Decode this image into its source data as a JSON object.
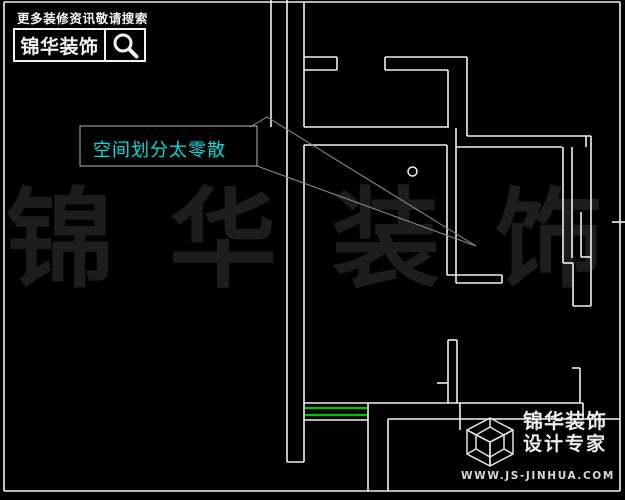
{
  "colors": {
    "background": "#000000",
    "wall": "#f0f0f0",
    "window_green": "#00c400",
    "leader": "#8d8d8d",
    "label_border": "#aeb4b4",
    "label_text": "#00dcdc",
    "watermark": "#1d1d1d",
    "logo_white": "#f2f2f2",
    "logo_gray": "#d8d8d8"
  },
  "header": {
    "tagline": "更多装修资讯敬请搜索",
    "brand": "锦华装饰",
    "search_icon": "magnifier-icon"
  },
  "annotation": {
    "text": "空间划分太零散"
  },
  "watermark": {
    "text": "锦华装饰"
  },
  "footer": {
    "cube_icon": "wireframe-cube-icon",
    "brand_line1": "锦华装饰",
    "brand_line2": "设计专家",
    "website": "WWW.JS-JINHUA.COM"
  },
  "floorplan": {
    "canvas": {
      "width": 625,
      "height": 500
    },
    "wall_segments": [
      [
        4,
        2,
        620,
        2
      ],
      [
        620,
        2,
        620,
        491
      ],
      [
        4,
        491,
        620,
        491
      ],
      [
        4,
        2,
        4,
        491
      ],
      [
        271,
        0,
        271,
        127
      ],
      [
        287,
        0,
        287,
        462
      ],
      [
        304,
        3,
        304,
        127
      ],
      [
        304,
        145,
        304,
        462
      ],
      [
        287,
        462,
        304,
        462
      ],
      [
        304,
        57,
        337,
        57
      ],
      [
        337,
        57,
        337,
        70
      ],
      [
        304,
        70,
        337,
        70
      ],
      [
        385,
        57,
        467,
        57
      ],
      [
        385,
        57,
        385,
        70
      ],
      [
        385,
        70,
        448,
        70
      ],
      [
        448,
        70,
        448,
        127
      ],
      [
        467,
        57,
        467,
        136
      ],
      [
        304,
        127,
        449,
        127
      ],
      [
        304,
        145,
        447,
        145
      ],
      [
        467,
        136,
        591,
        136
      ],
      [
        456,
        147,
        562,
        147
      ],
      [
        586,
        136,
        586,
        147
      ],
      [
        447,
        145,
        447,
        275
      ],
      [
        456,
        128,
        456,
        283
      ],
      [
        447,
        275,
        502,
        275
      ],
      [
        456,
        283,
        502,
        283
      ],
      [
        502,
        275,
        502,
        283
      ],
      [
        563,
        147,
        563,
        263
      ],
      [
        572,
        147,
        572,
        258
      ],
      [
        563,
        263,
        573,
        263
      ],
      [
        573,
        263,
        573,
        306
      ],
      [
        591,
        136,
        591,
        306
      ],
      [
        581,
        257,
        591,
        257
      ],
      [
        581,
        212,
        581,
        257
      ],
      [
        573,
        306,
        591,
        306
      ],
      [
        448,
        340,
        448,
        403
      ],
      [
        457,
        340,
        457,
        403
      ],
      [
        448,
        340,
        457,
        340
      ],
      [
        437,
        383,
        448,
        383
      ],
      [
        304,
        403,
        368,
        403
      ],
      [
        368,
        403,
        583,
        403
      ],
      [
        580,
        368,
        580,
        403
      ],
      [
        572,
        368,
        580,
        368
      ],
      [
        583,
        403,
        583,
        419
      ],
      [
        388,
        419,
        620,
        419
      ],
      [
        388,
        419,
        388,
        491
      ],
      [
        368,
        403,
        368,
        491
      ],
      [
        460,
        403,
        460,
        430
      ],
      [
        304,
        420,
        368,
        420
      ],
      [
        612,
        222,
        625,
        222
      ]
    ],
    "window_segments": [
      [
        305,
        408,
        367,
        408
      ],
      [
        305,
        415,
        367,
        415
      ]
    ],
    "leader_polylines": [
      [
        [
          250,
          127
        ],
        [
          267,
          117
        ],
        [
          476,
          246
        ]
      ],
      [
        [
          257,
          166
        ],
        [
          476,
          246
        ]
      ]
    ],
    "label_box": {
      "x": 80,
      "y": 126,
      "w": 177,
      "h": 40
    },
    "circle": {
      "cx": 412.5,
      "cy": 171.5,
      "r": 4.5
    }
  }
}
